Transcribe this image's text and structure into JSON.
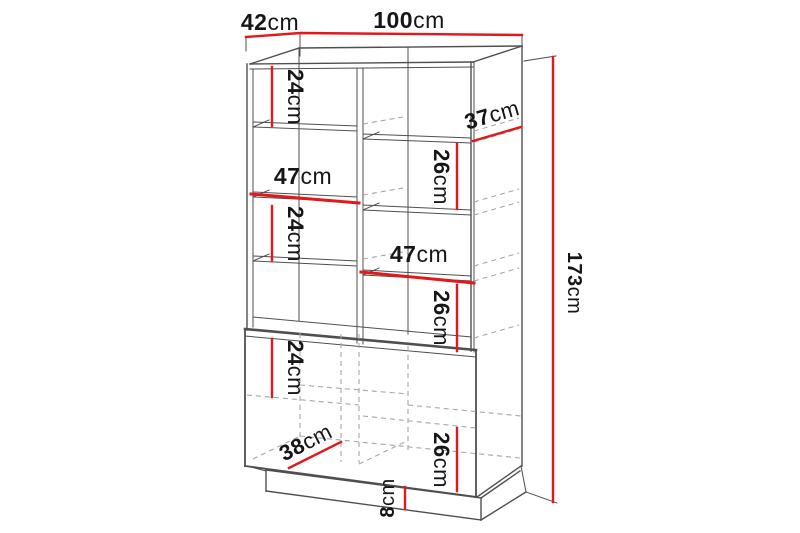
{
  "diagram": {
    "colors": {
      "dimension_red": "#e2191b",
      "outline": "#4f4f4f",
      "hidden": "#a6a6a6",
      "text": "#161616",
      "background": "#ffffff"
    },
    "labels": {
      "depth_top": {
        "value": "42",
        "unit": "cm"
      },
      "width_top": {
        "value": "100",
        "unit": "cm"
      },
      "height_total": {
        "value": "173",
        "unit": "cm"
      },
      "upper_left_gap": {
        "value": "24",
        "unit": "cm"
      },
      "upper_shelf_depth": {
        "value": "37",
        "unit": "cm"
      },
      "upper_right_gap": {
        "value": "26",
        "unit": "cm"
      },
      "left_shelf_width": {
        "value": "47",
        "unit": "cm"
      },
      "mid_left_gap": {
        "value": "24",
        "unit": "cm"
      },
      "right_shelf_width": {
        "value": "47",
        "unit": "cm"
      },
      "mid_right_gap": {
        "value": "26",
        "unit": "cm"
      },
      "lower_left_gap": {
        "value": "24",
        "unit": "cm"
      },
      "lower_shelf_depth": {
        "value": "38",
        "unit": "cm"
      },
      "lower_right_gap": {
        "value": "26",
        "unit": "cm"
      },
      "plinth_height": {
        "value": "8",
        "unit": "cm"
      }
    }
  }
}
